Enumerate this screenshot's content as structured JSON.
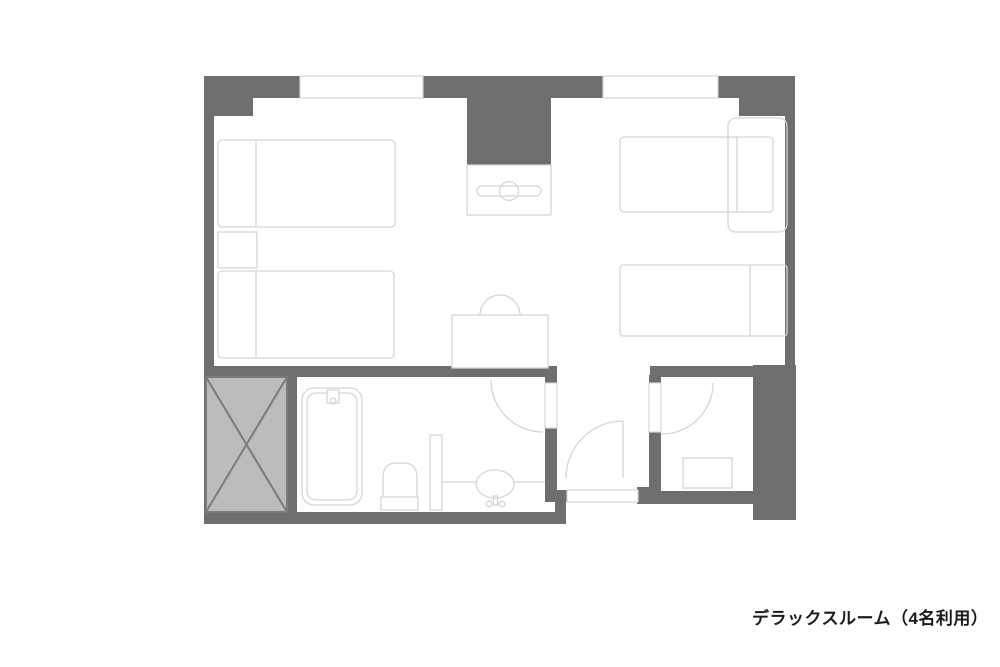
{
  "caption": "デラックスルーム（4名利用）",
  "colors": {
    "wall": "#6e6e6e",
    "furniture_line": "#d5d5d5",
    "shaft_fill": "#bcbcbc",
    "shaft_line": "#7b7b7b",
    "text": "#1b1b1b",
    "background": "#ffffff"
  },
  "fixtures": [
    "twin-bed-left-1",
    "twin-bed-left-2",
    "nightstand",
    "bed-right-1",
    "bed-right-2",
    "bench-sofa",
    "tv-counter",
    "desk",
    "chair",
    "bathtub",
    "toilet",
    "wash-basin",
    "partition",
    "toilet-room-cabinet",
    "elevator-shaft",
    "window-left",
    "window-right",
    "bathroom-door",
    "toilet-room-door",
    "entrance-door"
  ]
}
